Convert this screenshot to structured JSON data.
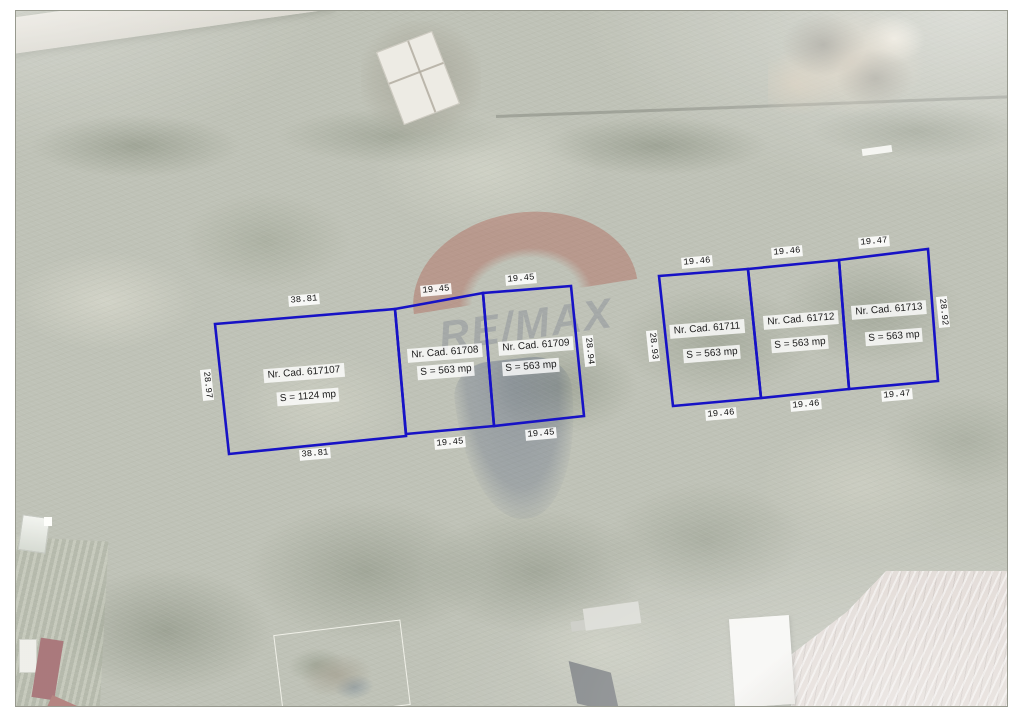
{
  "map": {
    "north_label": "N",
    "watermark_text": "RE/MAX",
    "colors": {
      "parcel_line": "#1712c6"
    },
    "parcels": [
      {
        "cad": "Nr. Cad. 617107",
        "area": "S = 1124 mp",
        "dim_top": "38.81",
        "dim_bottom": "38.81",
        "dim_left": "28.97"
      },
      {
        "cad": "Nr. Cad. 61708",
        "area": "S = 563 mp",
        "dim_top": "19.45",
        "dim_bottom": "19.45"
      },
      {
        "cad": "Nr. Cad. 61709",
        "area": "S = 563 mp",
        "dim_top": "19.45",
        "dim_bottom": "19.45",
        "dim_right": "28.94"
      },
      {
        "cad": "Nr. Cad. 61711",
        "area": "S = 563 mp",
        "dim_top": "19.46",
        "dim_bottom": "19.46",
        "dim_left": "28.93"
      },
      {
        "cad": "Nr. Cad. 61712",
        "area": "S = 563 mp",
        "dim_top": "19.46",
        "dim_bottom": "19.46"
      },
      {
        "cad": "Nr. Cad. 61713",
        "area": "S = 563 mp",
        "dim_top": "19.47",
        "dim_bottom": "19.47",
        "dim_right": "28.92"
      }
    ]
  }
}
